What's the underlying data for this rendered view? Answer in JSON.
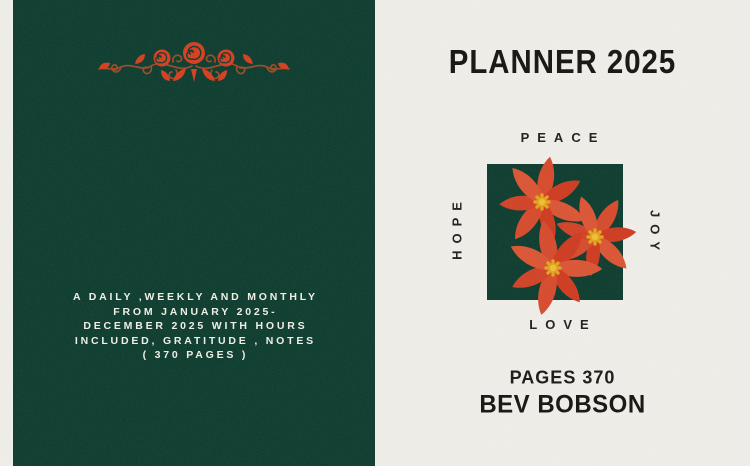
{
  "back_cover": {
    "description_lines": [
      "A DAILY ,WEEKLY AND MONTHLY",
      "FROM JANUARY 2025-",
      "DECEMBER 2025 WITH HOURS",
      "INCLUDED, GRATITUDE , NOTES",
      "( 370 PAGES )"
    ]
  },
  "front_cover": {
    "title": "PLANNER 2025",
    "word_top": "PEACE",
    "word_left": "HOPE",
    "word_right": "JOY",
    "word_bottom": "LOVE",
    "pages_label": "PAGES 370",
    "author": "BEV BOBSON"
  },
  "icons": {
    "ornament": "rose-vine-ornament",
    "flowers": "red-poinsettia-flowers-illustration"
  },
  "colors": {
    "panel_green": "#0c3c2e",
    "paper_cream": "#f0efe9",
    "flower_red": "#d8492c",
    "flower_red_dark": "#cf3b20",
    "flower_center_yellow": "#e2a51c",
    "vine_brown": "#9c4a26",
    "ornament_red": "#d63e1f",
    "text_dark": "#151413",
    "text_light": "#f2f1e9"
  }
}
